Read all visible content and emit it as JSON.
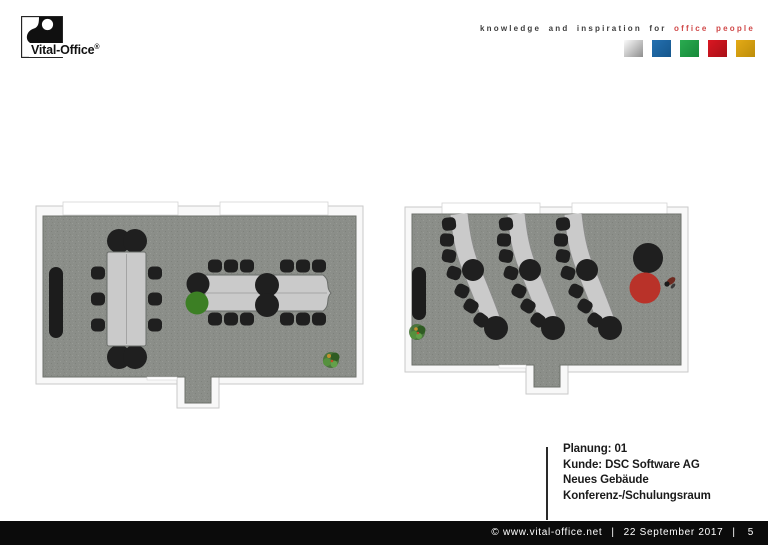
{
  "header": {
    "logo": {
      "brand": "Vital-Office",
      "registered": "®"
    },
    "tagline": {
      "prefix": "knowledge and inspiration for",
      "highlight": "office people"
    },
    "color_squares": [
      {
        "name": "silver",
        "from": "#fbfbfb",
        "to": "#8e8e8e"
      },
      {
        "name": "blue",
        "from": "#2470b0",
        "to": "#15568c"
      },
      {
        "name": "green",
        "from": "#2aab50",
        "to": "#17893a"
      },
      {
        "name": "red",
        "from": "#da1722",
        "to": "#a81017"
      },
      {
        "name": "gold",
        "from": "#e4aa16",
        "to": "#bd8d0a"
      }
    ]
  },
  "plan_info": {
    "lines": [
      "Planung: 01",
      "Kunde: DSC Software AG",
      "Neues Gebäude",
      "Konferenz-/Schulungsraum"
    ]
  },
  "footer": {
    "copyright": "© www.vital-office.net",
    "separator": "|",
    "date": "22 September 2017",
    "page_number": "5"
  },
  "colors": {
    "tagline_text": "#3d3d3d",
    "tagline_highlight": "#d04848",
    "footer_bg": "#0b0b0b",
    "footer_text": "#ffffff",
    "floor": "#8b8e89",
    "wall": "#f8f8f8",
    "table": "#cacaca",
    "chair": "#1f1f1f",
    "sideboard": "#1c1c1c",
    "stool_green": "#3c7f24",
    "table_red": "#b93229",
    "info_text": "#1a1a1a"
  },
  "floorplans": {
    "left": {
      "conference_table_chairs": 10,
      "wave_table_side_chairs": 12,
      "round_seats": 4,
      "green_round_seats": 1,
      "sideboards": 1,
      "plants": 1
    },
    "right": {
      "desk_rows": 3,
      "chairs_per_desk": 7,
      "round_seats_per_desk": 2,
      "presenter_red_tables": 1,
      "presenter_chairs": 1,
      "persons": 1,
      "sideboards": 1,
      "plants": 1
    }
  }
}
